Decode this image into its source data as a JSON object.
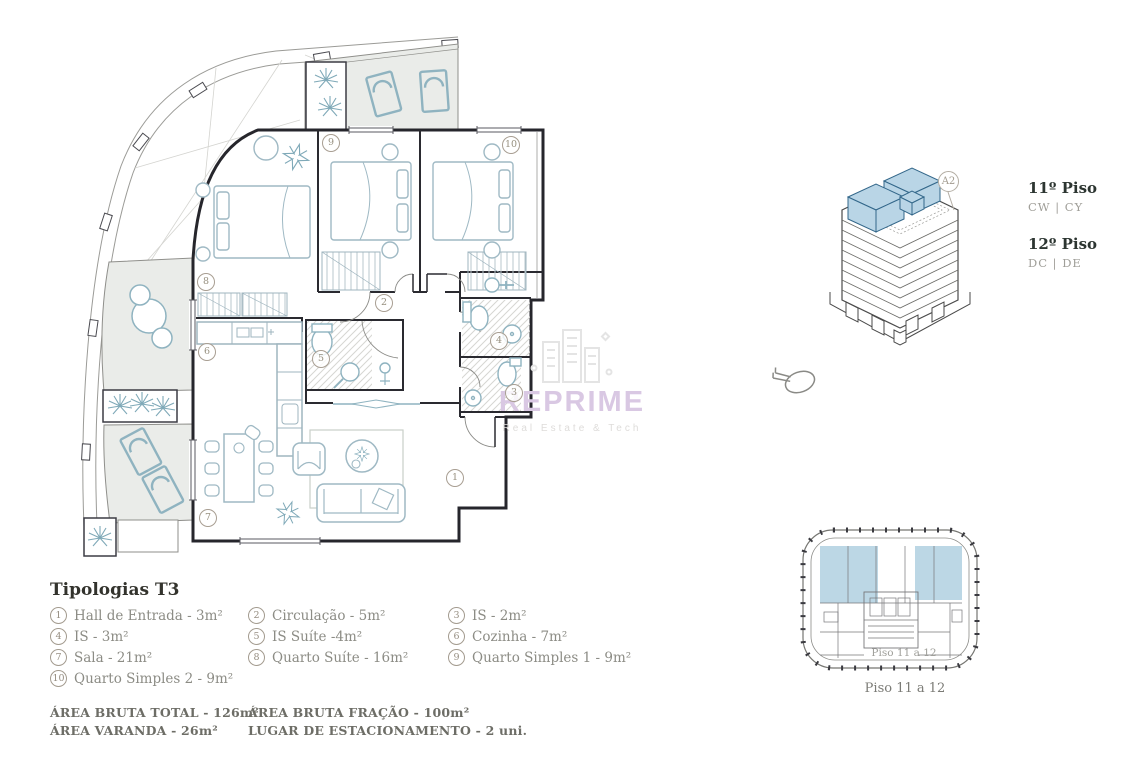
{
  "plan": {
    "watermark": {
      "brand": "REPRIME",
      "tagline": "Real Estate & Tech"
    },
    "rooms": [
      {
        "number": "1"
      },
      {
        "number": "2"
      },
      {
        "number": "3"
      },
      {
        "number": "4"
      },
      {
        "number": "5"
      },
      {
        "number": "6"
      },
      {
        "number": "7"
      },
      {
        "number": "8"
      },
      {
        "number": "9"
      },
      {
        "number": "10"
      }
    ]
  },
  "side_panel": {
    "unit_badge": "A2",
    "floors": [
      {
        "title": "11º Piso",
        "codes": "CW | CY"
      },
      {
        "title": "12º Piso",
        "codes": "DC | DE"
      }
    ],
    "keyplan": {
      "inner_label": "Piso 11 a 12",
      "caption": "Piso 11 a 12"
    }
  },
  "legend": {
    "title": "Tipologias T3",
    "items": [
      {
        "num": "1",
        "label": "Hall de Entrada - 3m²"
      },
      {
        "num": "2",
        "label": "Circulação - 5m²"
      },
      {
        "num": "3",
        "label": "IS - 2m²"
      },
      {
        "num": "4",
        "label": "IS - 3m²"
      },
      {
        "num": "5",
        "label": "IS Suíte -4m²"
      },
      {
        "num": "6",
        "label": "Cozinha - 7m²"
      },
      {
        "num": "7",
        "label": "Sala - 21m²"
      },
      {
        "num": "8",
        "label": "Quarto Suíte - 16m²"
      },
      {
        "num": "9",
        "label": "Quarto Simples 1 - 9m²"
      },
      {
        "num": "10",
        "label": "Quarto Simples 2 - 9m²"
      }
    ],
    "totals": [
      {
        "label": "ÁREA BRUTA TOTAL - 126m²"
      },
      {
        "label": "ÁREA VARANDA - 26m²"
      },
      {
        "label": "ÁREA BRUTA FRAÇÃO - 100m²"
      },
      {
        "label": "LUGAR DE ESTACIONAMENTO - 2 uni."
      }
    ]
  },
  "colors": {
    "highlight_blue": "#bcd7e5",
    "furniture_teal": "#8fb3c0",
    "watermark_purple": "#d9c8e3",
    "wall_dark": "#26262c"
  }
}
